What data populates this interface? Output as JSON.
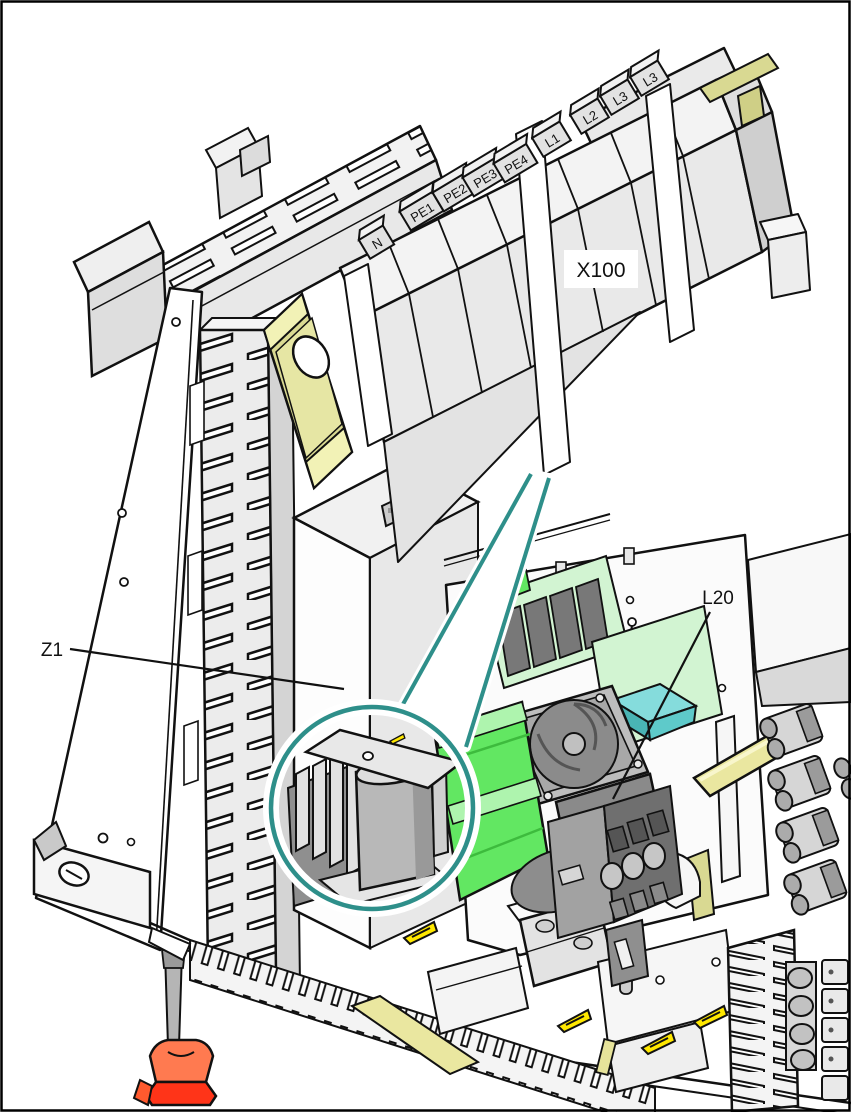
{
  "document": {
    "type": "isometric-technical-illustration"
  },
  "labels": {
    "terminal_block": "X100",
    "line_filter": "Z1",
    "contactor": "L20"
  },
  "terminal_tabs": [
    "N",
    "PE1",
    "PE2",
    "PE3",
    "PE4",
    "L1",
    "L2",
    "L3",
    "L3"
  ],
  "icons": {
    "warning_triangle": "triangle-with-slash"
  },
  "colors": {
    "callout": "#2e8f8a",
    "pcb_light_green": "#d2f4d2",
    "pcb_bright_green": "#62e762",
    "pcb_bright_green_light": "#aef4ae",
    "component_cyan_top": "#85dcdc",
    "component_cyan_side": "#49b4b4",
    "din_rail": "#d9d992",
    "din_rail_light": "#f2f2b6",
    "busbar": "#eae7a0",
    "warning_yellow": "#ffe800",
    "screwdriver_red": "#ff3418",
    "screwdriver_red_light": "#ff7a50"
  }
}
